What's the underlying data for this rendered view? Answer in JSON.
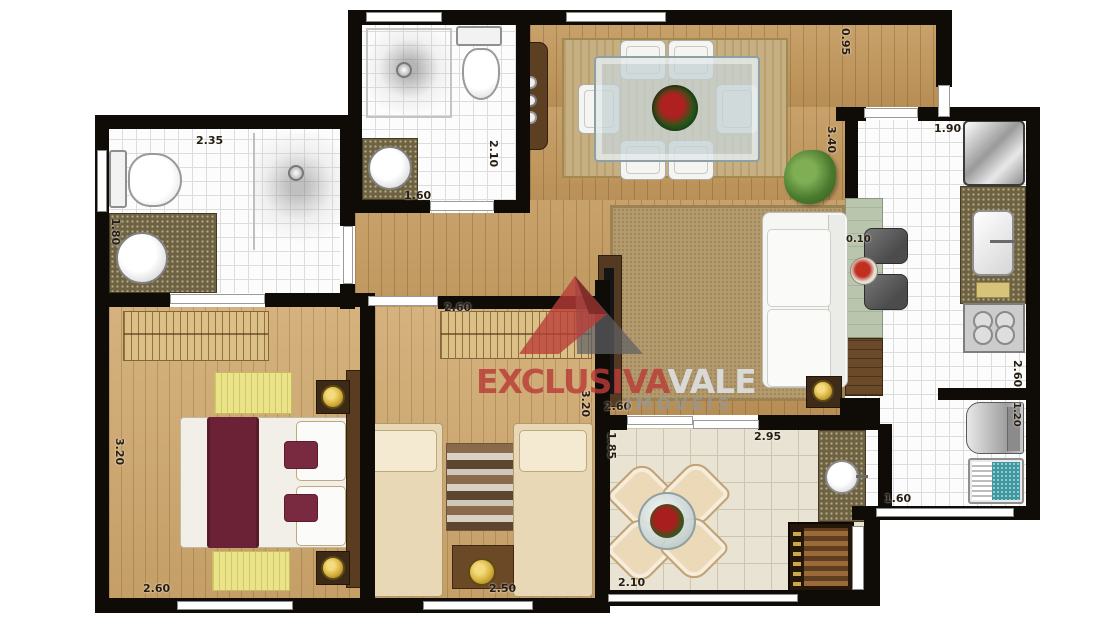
{
  "watermark": {
    "brand_primary": "EXCLUSIVA",
    "brand_secondary": "VALE",
    "subtitle": "IMÓVEIS"
  },
  "dimension_labels": {
    "bath1_width": "2.35",
    "bath1_depth": "1.80",
    "bath2_depth": "2.10",
    "bath2_door": "1.60",
    "entry_width": "0.95",
    "living_length": "3.40",
    "kitchen_width": "1.90",
    "counter_overhang": "0.10",
    "kitchen_length": "2.60",
    "washer_width": "1.20",
    "service_width": "1.60",
    "bed2_wardrobe": "2.60",
    "bed2_length": "3.20",
    "bed2_width": "2.50",
    "bed1_length": "3.20",
    "bed1_width": "2.60",
    "living_width": "2.60",
    "balcony_depth": "1.85",
    "balcony_width": "2.95",
    "balcony_span": "2.10"
  },
  "colors": {
    "wall": "#0f0c08",
    "wood_floor": "#c2975a",
    "bedroom_floor": "#cfa76c",
    "tile": "#fcfcfc",
    "balcony_tile": "#e9e3d4",
    "granite": "#6e6244",
    "brand_red": "#b93e3a",
    "brand_gray": "#d6d6d6",
    "maroon_bed": "#6b2236",
    "counter_green": "#b9c6ad",
    "laundry_teal": "#3e98a0",
    "gold": "#d8b23f"
  }
}
